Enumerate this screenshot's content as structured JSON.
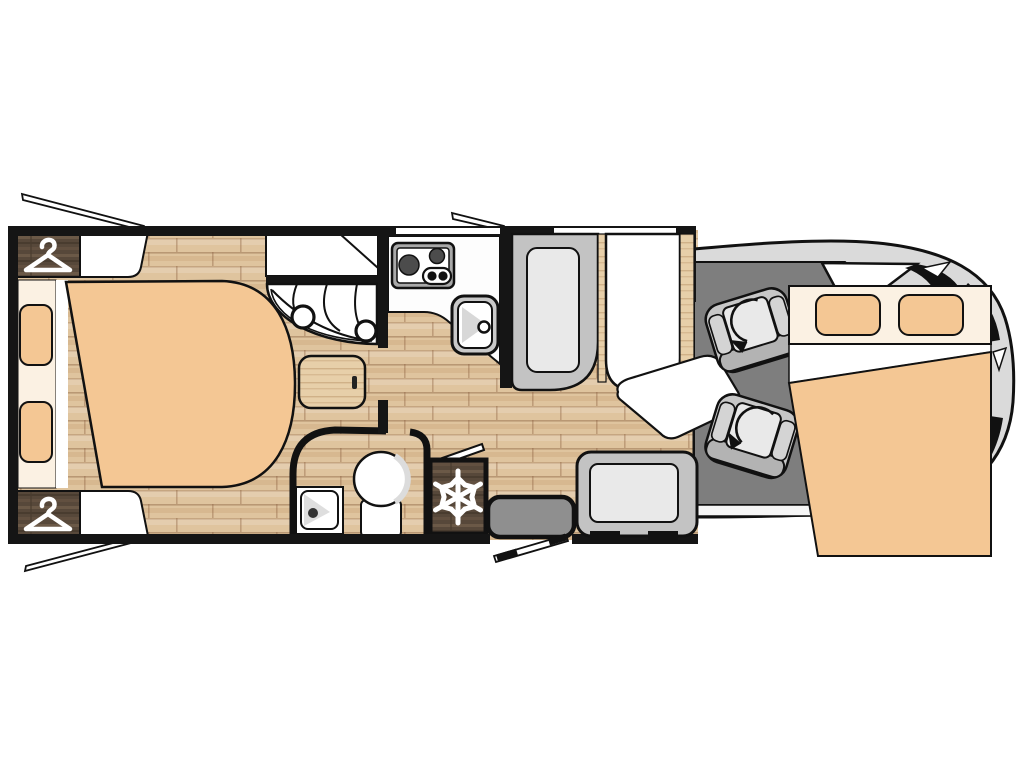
{
  "diagram": {
    "type": "motorhome-floorplan",
    "view": "top-down",
    "visible_text": [],
    "areas": [
      {
        "name": "rear-island-bed",
        "desc": "large bed with two pillows at rear (left)"
      },
      {
        "name": "wardrobe-top",
        "desc": "dark wood wardrobe with clothes hanger icon"
      },
      {
        "name": "wardrobe-bottom",
        "desc": "dark wood wardrobe with clothes hanger icon"
      },
      {
        "name": "shower-cubicle",
        "desc": "corner shower with curtain arc and two heads"
      },
      {
        "name": "kitchen",
        "desc": "counter with two-burner hob and sink"
      },
      {
        "name": "washroom",
        "desc": "curved-wall room with toilet and corner basin"
      },
      {
        "name": "fridge",
        "desc": "dark wood cabinet with snowflake symbol"
      },
      {
        "name": "entry-door",
        "desc": "entrance step with open door"
      },
      {
        "name": "dinette",
        "desc": "bench seats facing white table"
      },
      {
        "name": "cab",
        "desc": "driver cab with two swivel seats and rotation arrows"
      },
      {
        "name": "drop-down-bed",
        "desc": "front bed over cab with two pillows"
      },
      {
        "name": "vehicle-nose",
        "desc": "gray van front outline with windshield"
      }
    ],
    "icons": [
      "hanger-icon",
      "snowflake-icon",
      "swivel-arrow-icon"
    ],
    "windows_open": [
      "rear-top",
      "rear-bottom",
      "kitchen-top"
    ]
  },
  "colors": {
    "wall": "#151515",
    "floor-wood": "#dfc49e",
    "floor-line": "#8b6240",
    "dark-wood": "#57483a",
    "dark-wood-light": "#6b5947",
    "dark-wood-deep": "#493c2f",
    "light-wood": "#e7cfa9",
    "mattress": "#f4c794",
    "linen": "#fbf1e3",
    "pure-white": "#ffffff",
    "cab-floor": "#7e7e7e",
    "van-body": "#dadada",
    "seat-gray": "#c7c7c7",
    "seat-cushion": "#e9e9e9",
    "seat-back": "#b3b3b3",
    "bench-outer": "#c3c3c3",
    "step-gray": "#8f8f8f",
    "appliance-rim": "#a9a9a9",
    "burner": "#4c4c4c",
    "sink-rim": "#c9c9c9"
  }
}
